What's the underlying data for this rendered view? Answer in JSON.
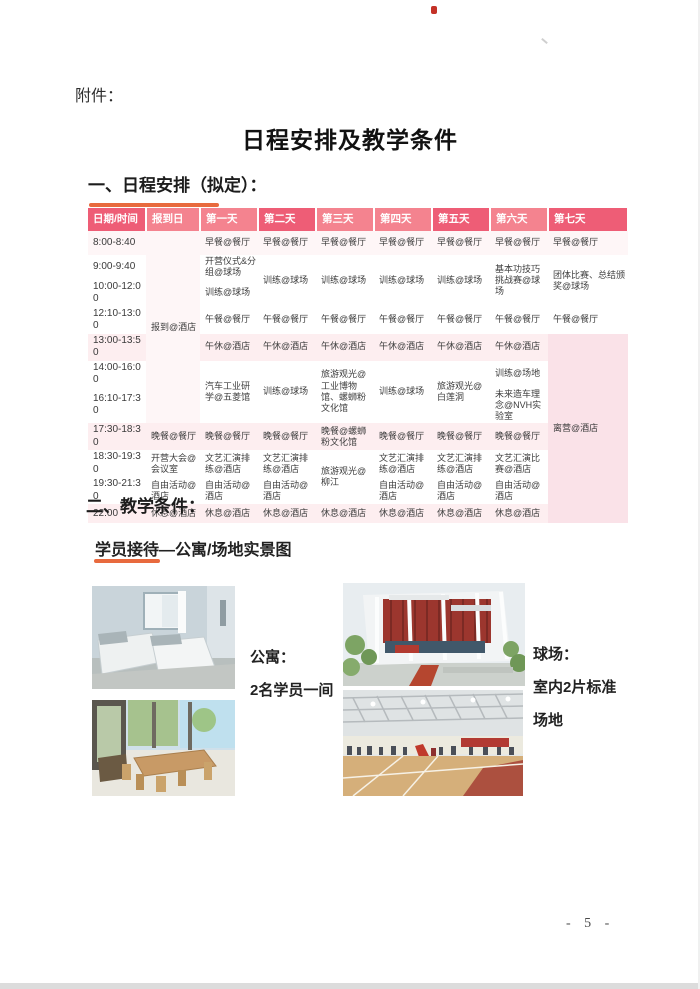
{
  "page": {
    "attachment_label": "附件：",
    "title": "日程安排及教学条件",
    "section1_heading": "一、日程安排（拟定）：",
    "section2_heading": "二、教学条件：",
    "gallery_heading": "学员接待—公寓/场地实景图",
    "page_number": "- 5 -"
  },
  "colors": {
    "header_pink_dark": "#ee5d76",
    "header_pink_light": "#f4838f",
    "row_pink": "#fdeef0",
    "accent_orange": "#e86a3e",
    "checkout_cell_pink": "#fae2e8"
  },
  "schedule": {
    "header": [
      "日期/时间",
      "报到日",
      "第一天",
      "第二天",
      "第三天",
      "第四天",
      "第五天",
      "第六天",
      "第七天"
    ],
    "times": [
      "8:00-8:40",
      "9:00-9:40",
      "10:00-12:00",
      "12:10-13:00",
      "13:00-13:50",
      "14:00-16:00",
      "16:10-17:30",
      "17:30-18:30",
      "18:30-19:30",
      "19:30-21:30",
      "22:00"
    ],
    "checkin": {
      "main": "报到@酒店",
      "dinner": "晚餐@餐厅",
      "meeting": "开营大会@会议室",
      "free": "自由活动@酒店",
      "rest": "休息@酒店"
    },
    "day1": {
      "breakfast": "早餐@餐厅",
      "opening": "开营仪式&分组@球场",
      "training_am": "训练@球场",
      "lunch": "午餐@餐厅",
      "nap": "午休@酒店",
      "visit": "汽车工业研学@五菱馆",
      "dinner": "晚餐@餐厅",
      "rehearsal": "文艺汇演排练@酒店",
      "free": "自由活动@酒店",
      "rest": "休息@酒店"
    },
    "day2": {
      "breakfast": "早餐@餐厅",
      "training_am": "训练@球场",
      "lunch": "午餐@餐厅",
      "nap": "午休@酒店",
      "training_pm": "训练@球场",
      "dinner": "晚餐@餐厅",
      "rehearsal": "文艺汇演排练@酒店",
      "free": "自由活动@酒店",
      "rest": "休息@酒店"
    },
    "day3": {
      "breakfast": "早餐@餐厅",
      "training_am": "训练@球场",
      "lunch": "午餐@餐厅",
      "nap": "午休@酒店",
      "tour_pm": "旅游观光@工业博物馆、螺蛳粉文化馆",
      "dinner": "晚餐@螺蛳粉文化馆",
      "tour_evening": "旅游观光@柳江",
      "rest": "休息@酒店"
    },
    "day4": {
      "breakfast": "早餐@餐厅",
      "training_am": "训练@球场",
      "lunch": "午餐@餐厅",
      "nap": "午休@酒店",
      "training_pm": "训练@球场",
      "dinner": "晚餐@餐厅",
      "rehearsal": "文艺汇演排练@酒店",
      "free": "自由活动@酒店",
      "rest": "休息@酒店"
    },
    "day5": {
      "breakfast": "早餐@餐厅",
      "training_am": "训练@球场",
      "lunch": "午餐@餐厅",
      "nap": "午休@酒店",
      "tour_pm": "旅游观光@白莲洞",
      "dinner": "晚餐@餐厅",
      "rehearsal": "文艺汇演排练@酒店",
      "free": "自由活动@酒店",
      "rest": "休息@酒店"
    },
    "day6": {
      "breakfast": "早餐@餐厅",
      "challenge": "基本功技巧挑战赛@球场",
      "lunch": "午餐@餐厅",
      "nap": "午休@酒店",
      "training_pm": "训练@场地",
      "lab": "未来造车理念@NVH实验室",
      "dinner": "晚餐@餐厅",
      "contest": "文艺汇演比赛@酒店",
      "free": "自由活动@酒店",
      "rest": "休息@酒店"
    },
    "day7": {
      "breakfast": "早餐@餐厅",
      "final": "团体比赛、总结颁奖@球场",
      "lunch": "午餐@餐厅",
      "checkout": "离营@酒店"
    }
  },
  "gallery": {
    "apartment": {
      "caption_title": "公寓：",
      "caption_desc": "2名学员一间",
      "photo1_name": "apartment-bedroom-photo",
      "photo2_name": "apartment-dining-photo"
    },
    "court": {
      "caption_title": "球场：",
      "caption_desc_line1": "室内2片标准",
      "caption_desc_line2": "场地",
      "photo1_name": "gym-exterior-photo",
      "photo2_name": "gym-court-photo"
    }
  }
}
